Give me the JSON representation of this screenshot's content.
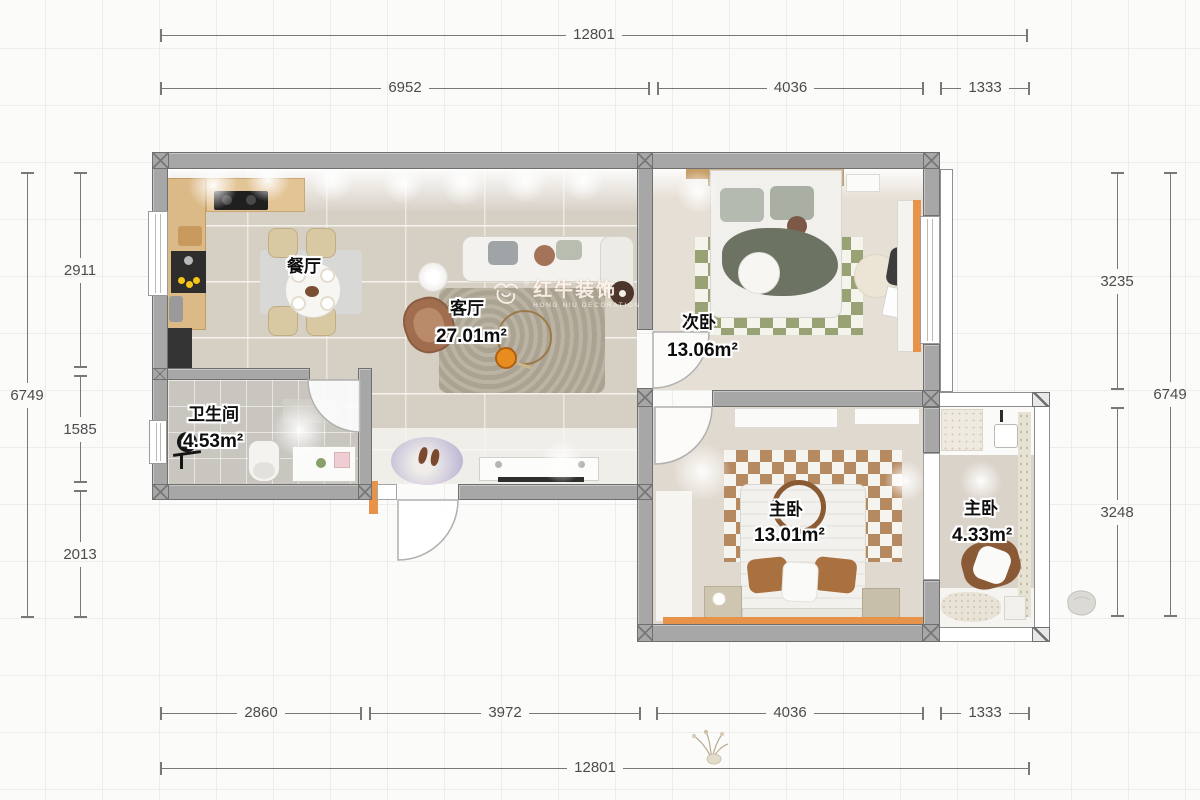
{
  "watermark": {
    "brand": "红牛装饰",
    "subtitle": "HONG NIU DECORATION",
    "registered": "®"
  },
  "rooms": {
    "dining": {
      "label": "餐厅"
    },
    "living": {
      "label": "客厅",
      "area": "27.01m²"
    },
    "second_bedroom": {
      "label": "次卧",
      "area": "13.06m²"
    },
    "bathroom": {
      "label": "卫生间",
      "area": "4.53m²"
    },
    "master_bedroom": {
      "label": "主卧",
      "area": "13.01m²"
    },
    "master_bedroom_small": {
      "label": "主卧",
      "area": "4.33m²"
    }
  },
  "dimensions": {
    "top_total": "12801",
    "top_segments": [
      {
        "value": "6952"
      },
      {
        "value": "4036"
      },
      {
        "value": "1333"
      }
    ],
    "left_total": "6749",
    "left_segments": [
      {
        "value": "2911"
      },
      {
        "value": "1585"
      },
      {
        "value": "2013"
      }
    ],
    "right_segments": [
      {
        "value": "3235"
      },
      {
        "value": "3248"
      }
    ],
    "right_total": "6749",
    "bottom_segments": [
      {
        "value": "2860"
      },
      {
        "value": "3972"
      },
      {
        "value": "4036"
      },
      {
        "value": "1333"
      }
    ],
    "bottom_total": "12801"
  },
  "colors": {
    "wall_gray": "#a7a7a7",
    "accent_orange": "#e8934a",
    "checker_green": "#98a274",
    "checker_brown": "#b07f52",
    "dim_line": "#787878"
  }
}
